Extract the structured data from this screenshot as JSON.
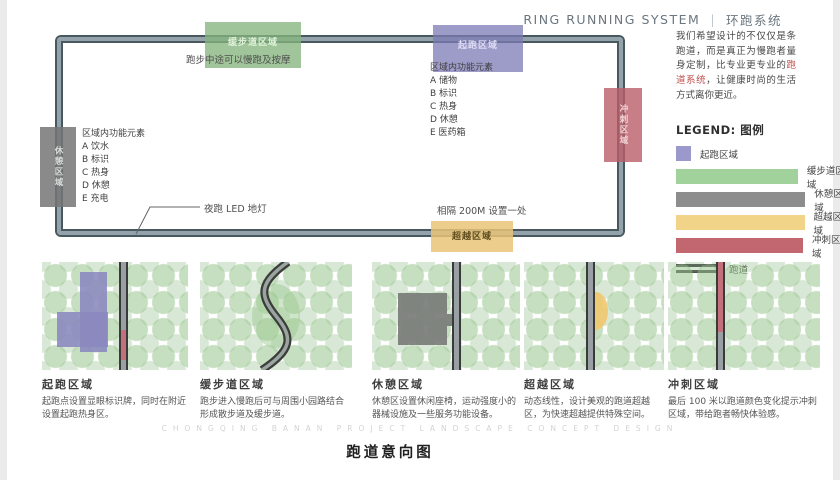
{
  "header": {
    "title_en": "RING RUNNING SYSTEM",
    "divider": "|",
    "title_zh": "环跑系统"
  },
  "intro": {
    "text_before": "我们希望设计的不仅仅是条跑道，而是真正为慢跑者量身定制，比专业更专业的",
    "highlight": "跑道系统",
    "text_after": "，让健康时尚的生活方式离你更近。"
  },
  "loop": {
    "zones": {
      "top_green": "缓步道区域",
      "top_purple": "起跑区域",
      "left_gray": "休憩区域",
      "right_red": "冲刺区域",
      "bottom_yellow": "超越区域"
    },
    "annotations": {
      "massage": "跑步中途可以慢跑及按摩",
      "led": "夜跑 LED 地灯",
      "spacing": "相隔 200M 设置一处",
      "features_right_title": "区域内功能元素",
      "features_right": [
        "A 储物",
        "B 标识",
        "C 热身",
        "D 休憩",
        "E 医药箱"
      ],
      "features_left_title": "区域内功能元素",
      "features_left": [
        "A 饮水",
        "B 标识",
        "C 热身",
        "D 休憩",
        "E 充电"
      ]
    }
  },
  "legend": {
    "title": "LEGEND: 图例",
    "items": [
      {
        "label": "起跑区域",
        "color": "#9b99cb"
      },
      {
        "label": "缓步道区域",
        "color": "#a2d29b"
      },
      {
        "label": "休憩区域",
        "color": "#8d8d8d"
      },
      {
        "label": "超越区域",
        "color": "#f2d488"
      },
      {
        "label": "冲刺区域",
        "color": "#c2666f"
      }
    ],
    "track_label": "跑道"
  },
  "cards": [
    {
      "title": "起跑区域",
      "desc": "起跑点设置显眼标识牌，同时在附近设置起跑热身区。"
    },
    {
      "title": "缓步道区域",
      "desc": "跑步进入慢跑后可与周围小园路结合形成散步道及缓步道。"
    },
    {
      "title": "休憩区域",
      "desc": "休憩区设置休闲座椅，运动强度小的器械设施及一些服务功能设备。"
    },
    {
      "title": "超越区域",
      "desc": "动态线性，设计美观的跑道超越区，为快速超越提供特殊空间。"
    },
    {
      "title": "冲刺区域",
      "desc": "最后 100 米以跑道颜色变化提示冲刺区域，带给跑者畅快体验感。"
    }
  ],
  "footer": {
    "watermark": "CHONGQING BANAN PROJECT LANDSCAPE CONCEPT DESIGN",
    "caption": "跑道意向图"
  },
  "colors": {
    "track_dark": "#47585f",
    "track_light": "#93a2ab",
    "zone_start": "#9b99cb",
    "zone_slow": "#a2d29b",
    "zone_rest": "#8d8d8d",
    "zone_overtake": "#f2d488",
    "zone_sprint": "#c2666f",
    "highlight_red": "#c0504d"
  }
}
